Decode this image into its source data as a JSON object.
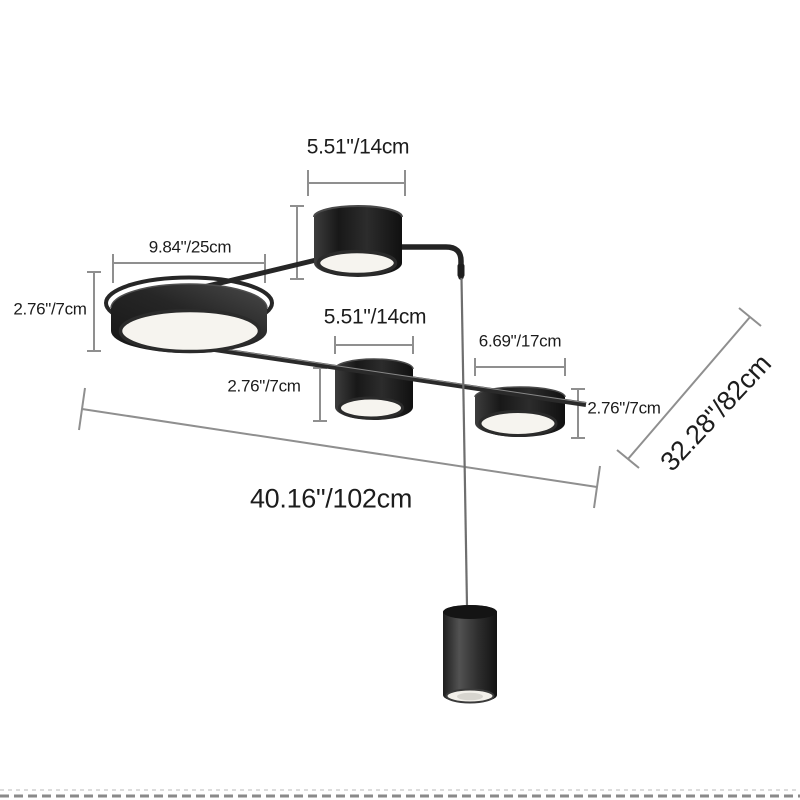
{
  "dimensions": {
    "top_drum_diameter": "5.51\"/14cm",
    "large_disc_diameter": "9.84\"/25cm",
    "large_disc_height": "2.76\"/7cm",
    "middle_drum_diameter": "5.51\"/14cm",
    "middle_drum_height": "2.76\"/7cm",
    "right_drum_diameter": "6.69\"/17cm",
    "right_drum_height": "2.76\"/7cm",
    "overall_width": "40.16\"/102cm",
    "overall_depth": "32.28\"/82cm"
  },
  "colors": {
    "background": "#ffffff",
    "label_text": "#1c1c1c",
    "dimension_line": "#8f8f8f",
    "lamp_black": "#262626",
    "lamp_face_white": "#f6f4ef",
    "cable_gray": "#6e6e6e",
    "border_dash_light": "#dcdcdc",
    "border_dash_dark": "#8a8a8a"
  }
}
